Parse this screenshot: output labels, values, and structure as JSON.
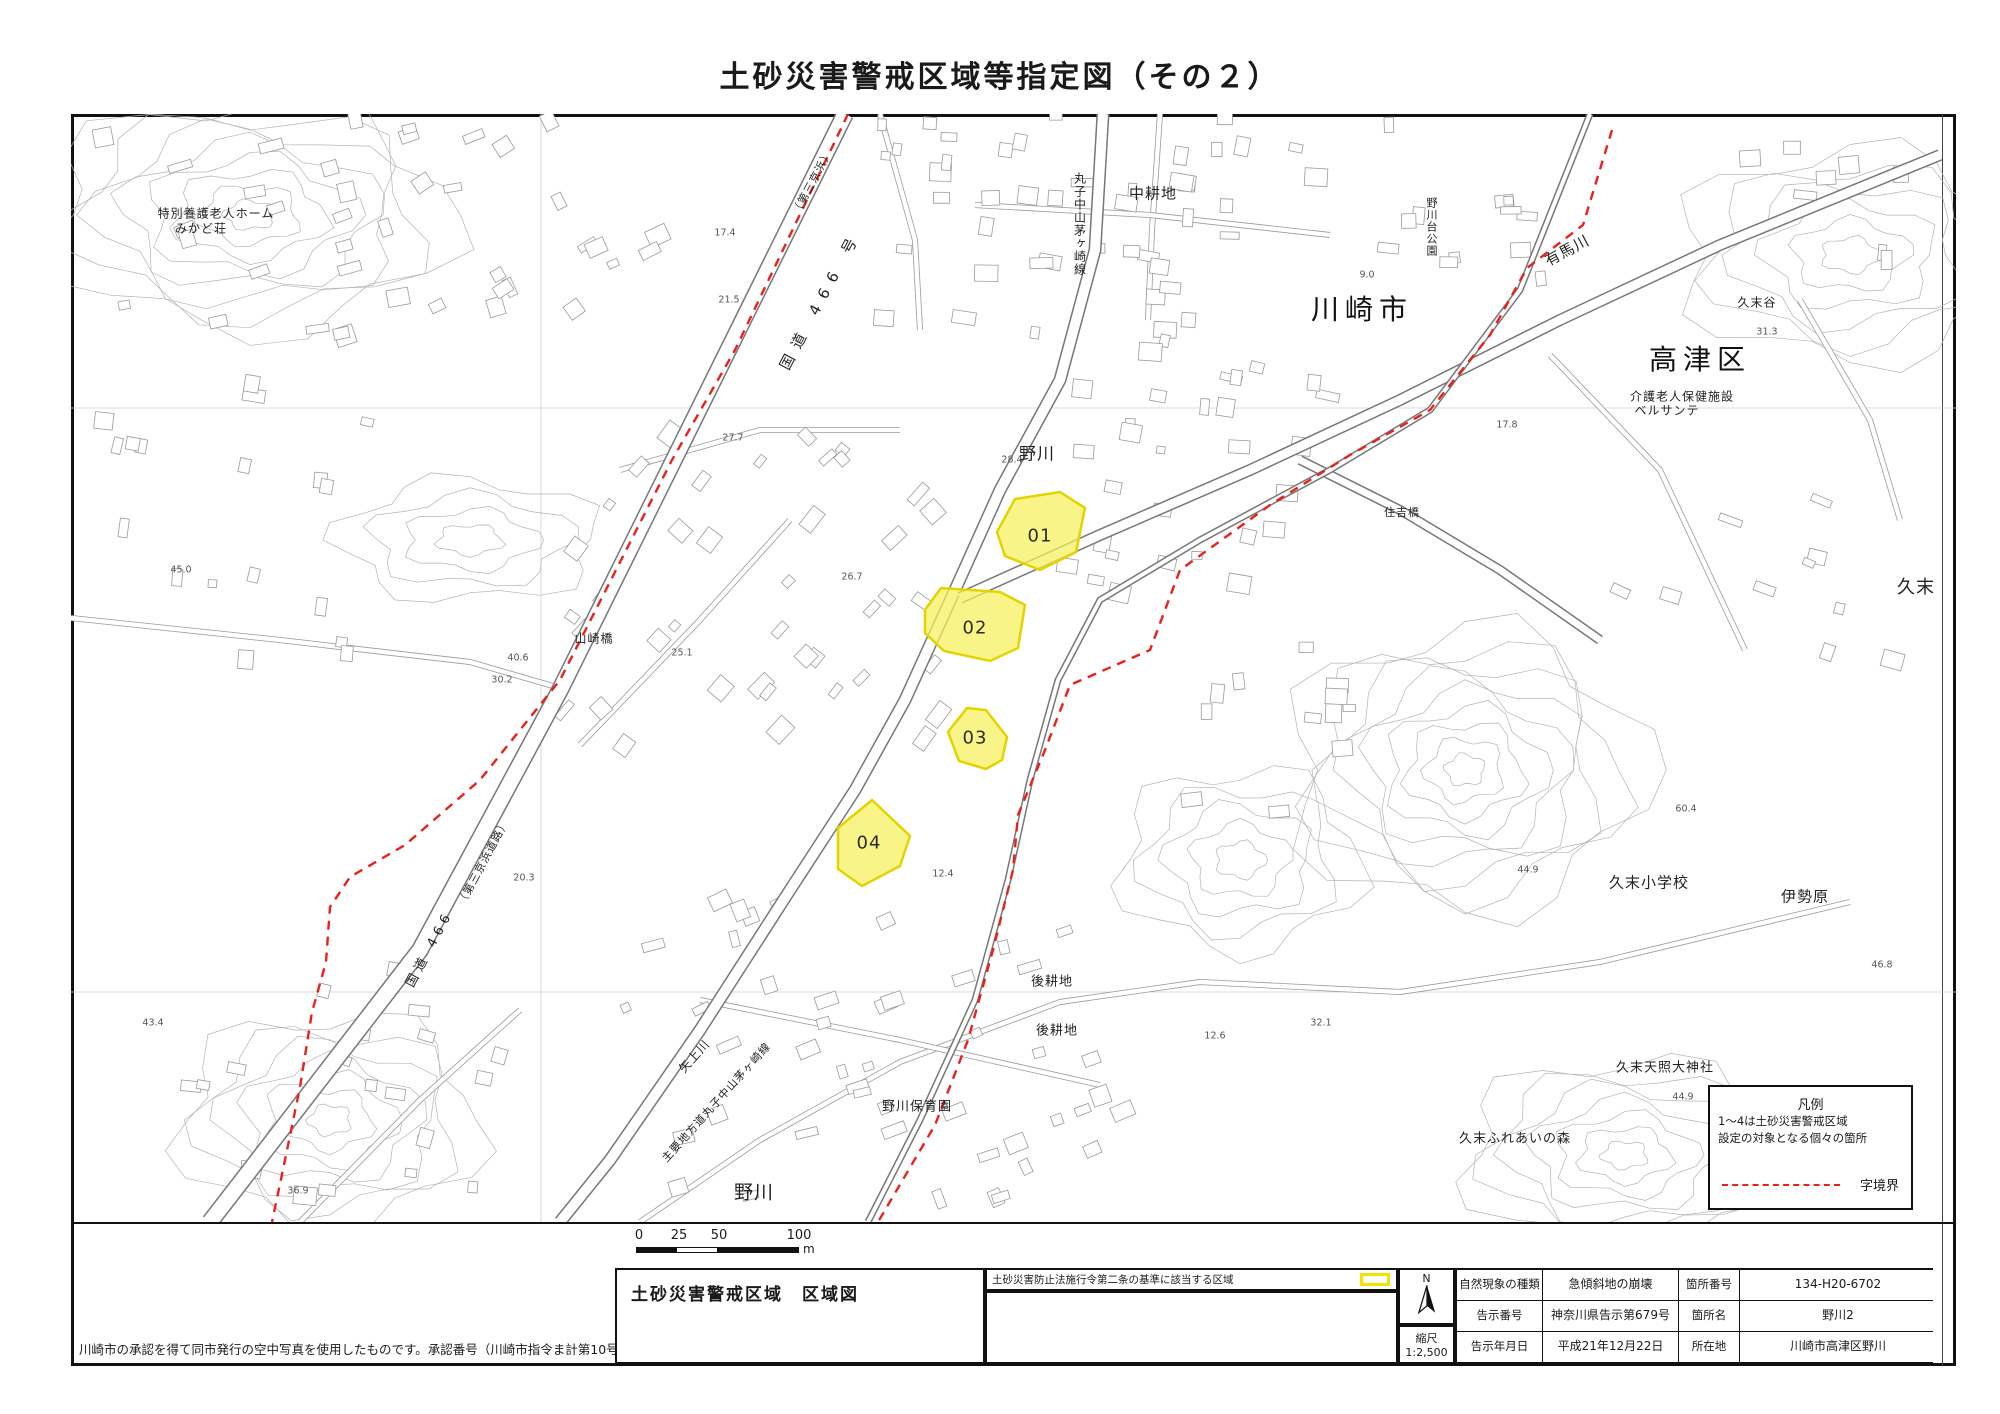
{
  "title": "土砂災害警戒区域等指定図（その２）",
  "map": {
    "labels": [
      {
        "text": "川崎市"
      },
      {
        "text": "高津区"
      },
      {
        "text": "久末"
      },
      {
        "text": "野川"
      },
      {
        "text": "野川"
      },
      {
        "text": "中耕地"
      },
      {
        "text": "後耕地"
      },
      {
        "text": "後耕地"
      },
      {
        "text": "特別養護老人ホーム"
      },
      {
        "text": "みかど荘"
      },
      {
        "text": "山崎橋"
      },
      {
        "text": "住吉橋"
      },
      {
        "text": "久末谷"
      },
      {
        "text": "介護老人保健施設"
      },
      {
        "text": "ベルサンテ"
      },
      {
        "text": "久末小学校"
      },
      {
        "text": "伊勢原"
      },
      {
        "text": "久末天照大神社"
      },
      {
        "text": "久末ふれあいの森"
      },
      {
        "text": "野川保育園"
      },
      {
        "text": "丸子中山茅ヶ崎線"
      },
      {
        "text": "野川台公園"
      },
      {
        "text": "有馬川"
      },
      {
        "text": "国道 466 号"
      },
      {
        "text": "（第三京浜）"
      },
      {
        "text": "国道 466"
      },
      {
        "text": "（第三京浜道路）"
      },
      {
        "text": "主要地方道丸子中山茅ヶ崎線"
      },
      {
        "text": "矢上川"
      }
    ],
    "zones": [
      {
        "id": "01"
      },
      {
        "id": "02"
      },
      {
        "id": "03"
      },
      {
        "id": "04"
      }
    ],
    "elevations": [
      {
        "v": "17.4"
      },
      {
        "v": "21.5"
      },
      {
        "v": "27.7"
      },
      {
        "v": "28.4"
      },
      {
        "v": "26.7"
      },
      {
        "v": "25.1"
      },
      {
        "v": "40.6"
      },
      {
        "v": "30.2"
      },
      {
        "v": "45.0"
      },
      {
        "v": "43.4"
      },
      {
        "v": "36.9"
      },
      {
        "v": "20.3"
      },
      {
        "v": "12.4"
      },
      {
        "v": "12.6"
      },
      {
        "v": "9.0"
      },
      {
        "v": "31.3"
      },
      {
        "v": "17.8"
      },
      {
        "v": "44.9"
      },
      {
        "v": "46.8"
      },
      {
        "v": "44.9"
      },
      {
        "v": "60.4"
      },
      {
        "v": "32.1"
      }
    ]
  },
  "legend": {
    "title": "凡例",
    "line1": "1～4は土砂災害警戒区域",
    "line2": "設定の対象となる個々の箇所",
    "boundary_label": "字境界"
  },
  "footer": {
    "note": "川崎市の承認を得て同市発行の空中写真を使用したものです。承認番号（川崎市指令ま計第10号）",
    "box_title": "土砂災害警戒区域　区域図",
    "legal_label": "土砂災害防止法施行令第二条の基準に該当する区域",
    "north_label": "N",
    "scale_label": "縮尺",
    "scale_value": "1:2,500",
    "scalebar": {
      "t0": "0",
      "t1": "25",
      "t2": "50",
      "t3": "100",
      "unit": "m"
    },
    "table": {
      "rows": [
        {
          "l1": "自然現象の種類",
          "v1": "急傾斜地の崩壊",
          "l2": "箇所番号",
          "v2": "134-H20-6702"
        },
        {
          "l1": "告示番号",
          "v1": "神奈川県告示第679号",
          "l2": "箇所名",
          "v2": "野川2"
        },
        {
          "l1": "告示年月日",
          "v1": "平成21年12月22日",
          "l2": "所在地",
          "v2": "川崎市高津区野川"
        }
      ]
    }
  },
  "colors": {
    "zone_fill": "#f6f05a",
    "zone_border": "#e3d400",
    "boundary_red": "#e8211a"
  }
}
